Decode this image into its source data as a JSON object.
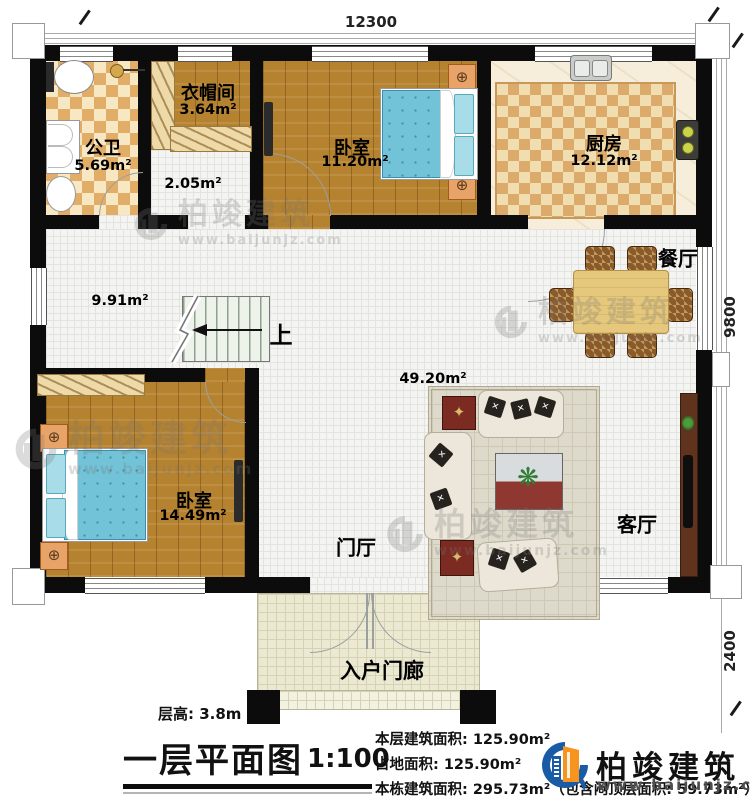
{
  "plan": {
    "dim_top": "12300",
    "dim_right_main": "9800",
    "dim_right_porch": "2400",
    "rooms": {
      "bathroom": {
        "name": "公卫",
        "area": "5.69m²"
      },
      "cloakroom": {
        "name": "衣帽间",
        "area": "3.64m²"
      },
      "small_hall": {
        "area": "2.05m²"
      },
      "bedroom_top": {
        "name": "卧室",
        "area": "11.20m²"
      },
      "kitchen": {
        "name": "厨房",
        "area": "12.12m²"
      },
      "dining": {
        "name": "餐厅"
      },
      "hall": {
        "area": "9.91m²"
      },
      "great_room": {
        "area": "49.20m²"
      },
      "bedroom_bottom": {
        "name": "卧室",
        "area": "14.49m²"
      },
      "foyer": {
        "name": "门厅"
      },
      "living": {
        "name": "客厅"
      },
      "porch": {
        "name": "入户门廊"
      }
    },
    "stairs_label": "上"
  },
  "watermark": {
    "name": "柏竣建筑",
    "url": "www.baijunjz.com"
  },
  "title_block": {
    "floor_height": "层高: 3.8m",
    "title": "一层平面图",
    "scale": "1:100",
    "stats": [
      "本层建筑面积: 125.90m²",
      "占地面积: 125.90m²",
      "本栋建筑面积: 295.73m²（包含闷顶层面积: 59.73m²）"
    ],
    "logo": {
      "name": "柏竣建筑",
      "url": "www.baijunjz.com"
    }
  }
}
